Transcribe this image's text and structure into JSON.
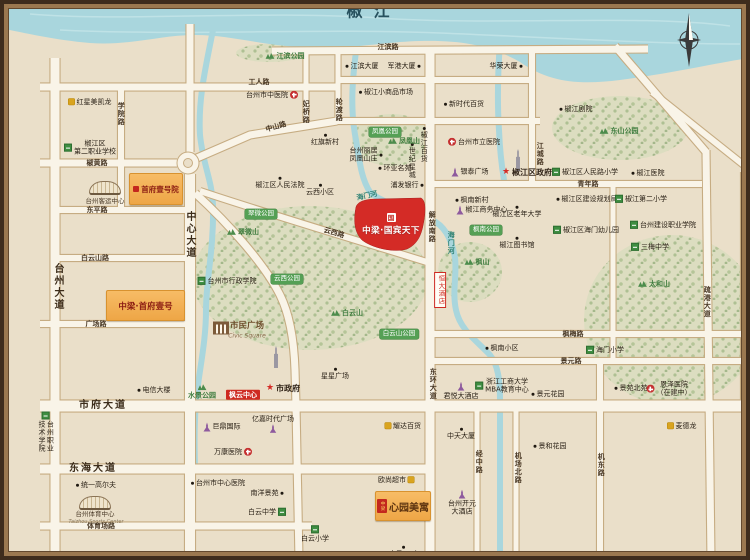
{
  "title": "椒江",
  "colors": {
    "river": "#A9D6DD",
    "road": "#F9F4E8",
    "road_edge": "#C6AC82",
    "background": "#EADFC9",
    "parcel_red": "#D42B26",
    "parcel_orange": "#F2AE55",
    "park_green": "#55A055",
    "frame_brown": "#3E2C1D",
    "river_title": "#27515E"
  },
  "parcels": {
    "p1": {
      "name": "首府壹号院",
      "x": 129,
      "y": 173,
      "w": 52,
      "h": 30
    },
    "p2": {
      "name": "中梁·首府壹号",
      "x": 106,
      "y": 290,
      "w": 77,
      "h": 29
    },
    "p3": {
      "name": "中梁·国宾天下",
      "logo": "国",
      "x": 357,
      "y": 198,
      "w": 68,
      "h": 52
    },
    "p4": {
      "name": "心园美寓",
      "seal": "中梁",
      "x": 375,
      "y": 491,
      "w": 54,
      "h": 28
    }
  },
  "marks": [
    {
      "k": "stad",
      "x": 105,
      "y": 188
    },
    {
      "k": "stad",
      "x": 95,
      "y": 503
    },
    {
      "k": "civic",
      "x": 221,
      "y": 328
    },
    {
      "k": "tower",
      "x": 276,
      "y": 357
    },
    {
      "k": "tower",
      "x": 518,
      "y": 160
    }
  ],
  "labels": [
    {
      "t": "椒江",
      "x": 368,
      "y": 11,
      "c": "ttl"
    },
    {
      "t": "江滨路",
      "x": 388,
      "y": 47,
      "c": "rd"
    },
    {
      "t": "工人路",
      "x": 259,
      "y": 82,
      "c": "rd"
    },
    {
      "t": "中山路",
      "x": 276,
      "y": 127,
      "c": "rd",
      "r": -16
    },
    {
      "t": "椒黄路",
      "x": 97,
      "y": 163,
      "c": "rd"
    },
    {
      "t": "东平路",
      "x": 97,
      "y": 210,
      "c": "rd"
    },
    {
      "t": "白云山路",
      "x": 95,
      "y": 258,
      "c": "rd"
    },
    {
      "t": "广场路",
      "x": 96,
      "y": 324,
      "c": "rd"
    },
    {
      "t": "市府大道",
      "x": 103,
      "y": 406,
      "c": "rdM"
    },
    {
      "t": "东海大道",
      "x": 93,
      "y": 469,
      "c": "rdM"
    },
    {
      "t": "体育场路",
      "x": 101,
      "y": 526,
      "c": "rd"
    },
    {
      "t": "学院路",
      "x": 121,
      "y": 114,
      "c": "rd",
      "v": 1
    },
    {
      "t": "台州大道",
      "x": 57,
      "y": 287,
      "c": "rdM",
      "v": 1
    },
    {
      "t": "中心大道",
      "x": 189,
      "y": 235,
      "c": "rdM",
      "v": 1
    },
    {
      "t": "妃桥路",
      "x": 306,
      "y": 112,
      "c": "rd",
      "v": 1
    },
    {
      "t": "轮渡路",
      "x": 339,
      "y": 110,
      "c": "rd",
      "v": 1
    },
    {
      "t": "云西路",
      "x": 334,
      "y": 233,
      "c": "rd",
      "r": 16
    },
    {
      "t": "解放南路",
      "x": 432,
      "y": 227,
      "c": "rd",
      "v": 1
    },
    {
      "t": "东环大道",
      "x": 433,
      "y": 384,
      "c": "rd",
      "v": 1
    },
    {
      "t": "江城路",
      "x": 540,
      "y": 154,
      "c": "rd",
      "v": 1
    },
    {
      "t": "青年路",
      "x": 588,
      "y": 184,
      "c": "rd"
    },
    {
      "t": "枫梅路",
      "x": 573,
      "y": 334,
      "c": "rd"
    },
    {
      "t": "景元路",
      "x": 571,
      "y": 361,
      "c": "rd"
    },
    {
      "t": "经中路",
      "x": 479,
      "y": 462,
      "c": "rd",
      "v": 1
    },
    {
      "t": "机场北路",
      "x": 518,
      "y": 468,
      "c": "rd",
      "v": 1
    },
    {
      "t": "机东路",
      "x": 601,
      "y": 465,
      "c": "rd",
      "v": 1
    },
    {
      "t": "疏港大道",
      "x": 707,
      "y": 302,
      "c": "rd",
      "v": 1
    },
    {
      "t": "海门河",
      "x": 367,
      "y": 196,
      "c": "riv",
      "r": -12
    },
    {
      "t": "海门河",
      "x": 451,
      "y": 243,
      "c": "riv",
      "v": 1
    },
    {
      "t": "江滨大厦",
      "x": 362,
      "y": 66,
      "c": "dot"
    },
    {
      "t": "军港大厦",
      "x": 404,
      "y": 66,
      "c": "dot",
      "d": "r"
    },
    {
      "t": "华荣大厦",
      "x": 506,
      "y": 66,
      "c": "dot",
      "d": "r"
    },
    {
      "t": "椒江小商品市场",
      "x": 386,
      "y": 92,
      "c": "dot"
    },
    {
      "t": "新时代百货",
      "x": 464,
      "y": 104,
      "c": "dot"
    },
    {
      "t": "红旗新村",
      "x": 325,
      "y": 140,
      "c": "dot",
      "d": "t"
    },
    {
      "t": "椒江区人民法院",
      "x": 280,
      "y": 183,
      "c": "dot",
      "d": "t"
    },
    {
      "t": "云西小区",
      "x": 320,
      "y": 190,
      "c": "dot",
      "d": "t"
    },
    {
      "t": "枫南新村",
      "x": 472,
      "y": 200,
      "c": "dot"
    },
    {
      "t": "椒江区老年大学",
      "x": 517,
      "y": 212,
      "c": "dot",
      "d": "t"
    },
    {
      "t": "椒江图书馆",
      "x": 517,
      "y": 243,
      "c": "dot",
      "d": "t"
    },
    {
      "t": "环亚名苑",
      "x": 395,
      "y": 168,
      "c": "dot"
    },
    {
      "t": "浦发银行",
      "x": 407,
      "y": 185,
      "c": "dot",
      "d": "r"
    },
    {
      "t": "椒江剧院",
      "x": 576,
      "y": 109,
      "c": "dot"
    },
    {
      "t": "椒江医院",
      "x": 648,
      "y": 173,
      "c": "dot"
    },
    {
      "t": "椒江区建设规划局",
      "x": 587,
      "y": 199,
      "c": "dot"
    },
    {
      "t": "星星广场",
      "x": 335,
      "y": 374,
      "c": "dot",
      "d": "t"
    },
    {
      "t": "电信大楼",
      "x": 154,
      "y": 390,
      "c": "dot"
    },
    {
      "t": "统一高尔夫",
      "x": 96,
      "y": 485,
      "c": "dot"
    },
    {
      "t": "中天大厦",
      "x": 461,
      "y": 434,
      "c": "dot",
      "d": "t"
    },
    {
      "t": "景元花园",
      "x": 548,
      "y": 394,
      "c": "dot"
    },
    {
      "t": "景苑北苑",
      "x": 631,
      "y": 388,
      "c": "dot"
    },
    {
      "t": "景和花园",
      "x": 550,
      "y": 446,
      "c": "dot"
    },
    {
      "t": "枫南小区",
      "x": 502,
      "y": 348,
      "c": "dot"
    },
    {
      "t": "宝马4S店",
      "x": 404,
      "y": 552,
      "c": "dot",
      "d": "t"
    },
    {
      "t": "南洋景苑",
      "x": 267,
      "y": 493,
      "c": "dot",
      "d": "r"
    },
    {
      "t": "台州市中心医院",
      "x": 218,
      "y": 483,
      "c": "dot"
    },
    {
      "t": "椒江百货",
      "x": 424,
      "y": 145,
      "c": "dot",
      "v": 1,
      "d": "t"
    },
    {
      "t": "世纪星城",
      "x": 412,
      "y": 161,
      "c": "dot",
      "v": 1,
      "d": "t"
    },
    {
      "t": "台州丽居\n凤凰山庄",
      "x": 366,
      "y": 155,
      "c": "dot",
      "d": "r"
    },
    {
      "t": "台州市中医院",
      "x": 272,
      "y": 95,
      "c": "hos",
      "d": "r"
    },
    {
      "t": "台州市立医院",
      "x": 474,
      "y": 142,
      "c": "hos"
    },
    {
      "t": "万康医院",
      "x": 233,
      "y": 452,
      "c": "hos",
      "d": "r"
    },
    {
      "t": "恩泽医院\n（在建中）",
      "x": 669,
      "y": 389,
      "c": "hos"
    },
    {
      "t": "椒江区\n第二职业学校",
      "x": 90,
      "y": 148,
      "c": "sch"
    },
    {
      "t": "台州职业\n技术学院",
      "x": 46,
      "y": 432,
      "c": "sch",
      "v": 1,
      "d": "t"
    },
    {
      "t": "台州市行政学院",
      "x": 227,
      "y": 281,
      "c": "sch"
    },
    {
      "t": "白云中学",
      "x": 267,
      "y": 512,
      "c": "sch",
      "d": "r"
    },
    {
      "t": "白云小学",
      "x": 315,
      "y": 534,
      "c": "sch",
      "d": "t"
    },
    {
      "t": "椒江区人民路小学",
      "x": 585,
      "y": 172,
      "c": "sch"
    },
    {
      "t": "椒江第二小学",
      "x": 641,
      "y": 199,
      "c": "sch"
    },
    {
      "t": "台州建设职业学院",
      "x": 663,
      "y": 225,
      "c": "sch"
    },
    {
      "t": "三梅中学",
      "x": 650,
      "y": 247,
      "c": "sch"
    },
    {
      "t": "海门小学",
      "x": 605,
      "y": 350,
      "c": "sch"
    },
    {
      "t": "浙江工商大学\nMBA教育中心",
      "x": 502,
      "y": 386,
      "c": "sch"
    },
    {
      "t": "椒江区海门幼儿园",
      "x": 586,
      "y": 230,
      "c": "sch"
    },
    {
      "t": "银泰广场",
      "x": 470,
      "y": 172,
      "c": "pur"
    },
    {
      "t": "椒江商务中心",
      "x": 482,
      "y": 210,
      "c": "pur"
    },
    {
      "t": "亿嘉时代广场",
      "x": 273,
      "y": 424,
      "c": "pur",
      "d": "b"
    },
    {
      "t": "巨鼎国际",
      "x": 222,
      "y": 427,
      "c": "pur"
    },
    {
      "t": "君悦大酒店",
      "x": 461,
      "y": 391,
      "c": "pur",
      "d": "t"
    },
    {
      "t": "台州开元\n大酒店",
      "x": 462,
      "y": 503,
      "c": "pur",
      "d": "t"
    },
    {
      "t": "凤凰公园",
      "x": 385,
      "y": 132,
      "c": "pk"
    },
    {
      "t": "翠微公园",
      "x": 261,
      "y": 214,
      "c": "pk"
    },
    {
      "t": "云西公园",
      "x": 287,
      "y": 279,
      "c": "pk"
    },
    {
      "t": "白云山公园",
      "x": 399,
      "y": 334,
      "c": "pk"
    },
    {
      "t": "枫南公园",
      "x": 486,
      "y": 230,
      "c": "pk"
    },
    {
      "t": "江滨公园",
      "x": 285,
      "y": 56,
      "c": "mtn"
    },
    {
      "t": "凤凰山",
      "x": 404,
      "y": 141,
      "c": "mtn"
    },
    {
      "t": "翠微山",
      "x": 243,
      "y": 232,
      "c": "mtn"
    },
    {
      "t": "白云山",
      "x": 347,
      "y": 313,
      "c": "mtn"
    },
    {
      "t": "枫山",
      "x": 477,
      "y": 262,
      "c": "mtn"
    },
    {
      "t": "东山公园",
      "x": 619,
      "y": 131,
      "c": "mtn"
    },
    {
      "t": "太和山",
      "x": 654,
      "y": 284,
      "c": "mtn"
    },
    {
      "t": "水景公园",
      "x": 202,
      "y": 392,
      "c": "mtn",
      "d": "t"
    },
    {
      "t": "红星美凯龙",
      "x": 90,
      "y": 102,
      "c": "yel"
    },
    {
      "t": "耀达百货",
      "x": 403,
      "y": 426,
      "c": "yel"
    },
    {
      "t": "欧尚超市",
      "x": 396,
      "y": 480,
      "c": "yel",
      "d": "r"
    },
    {
      "t": "麦德龙",
      "x": 682,
      "y": 426,
      "c": "yel"
    },
    {
      "t": "枫云中心",
      "x": 243,
      "y": 395,
      "c": "tag"
    },
    {
      "t": "恒大酒店",
      "x": 440,
      "y": 290,
      "c": "vtag",
      "v": 1
    },
    {
      "t": "市政府",
      "x": 283,
      "y": 389,
      "c": "gov"
    },
    {
      "t": "椒江区政府",
      "x": 527,
      "y": 173,
      "c": "gov"
    },
    {
      "t": "市民广场",
      "x": 247,
      "y": 326,
      "c": "civ1"
    },
    {
      "t": "Civic Square",
      "x": 247,
      "y": 336,
      "c": "civ2"
    },
    {
      "t": "台州客运中心",
      "x": 105,
      "y": 202,
      "c": "lm"
    },
    {
      "t": "台州体育中心",
      "x": 95,
      "y": 515,
      "c": "lm"
    },
    {
      "t": "Taizhou Sports Center",
      "x": 96,
      "y": 522,
      "c": "lmE"
    }
  ]
}
